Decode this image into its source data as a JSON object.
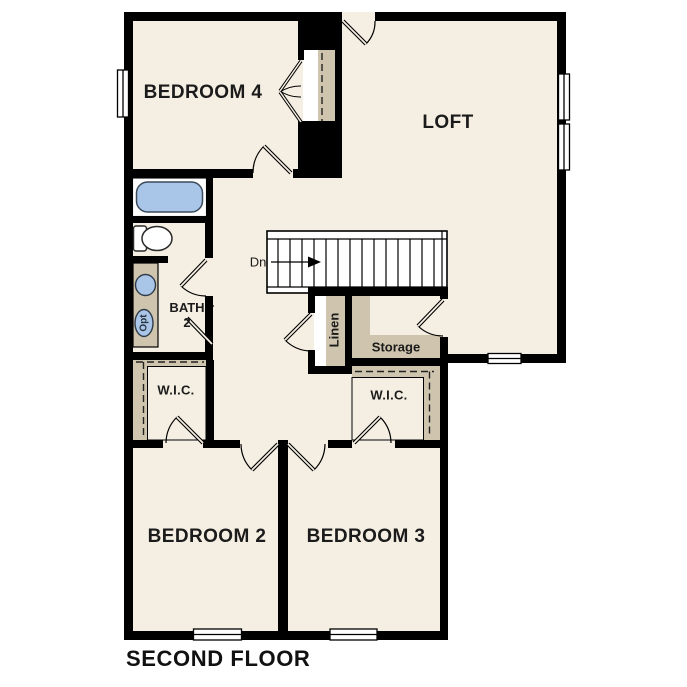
{
  "title": "SECOND FLOOR",
  "rooms": {
    "bedroom4": "BEDROOM 4",
    "loft": "LOFT",
    "bath_line1": "BATH",
    "bath_line2": "2",
    "wic_left": "W.I.C.",
    "wic_right": "W.I.C.",
    "linen": "Linen",
    "storage": "Storage",
    "bedroom2": "BEDROOM 2",
    "bedroom3": "BEDROOM 3"
  },
  "annotations": {
    "stairs_direction": "Dn",
    "optional_fixture": "Opt"
  },
  "colors": {
    "floor": "#f5efe3",
    "closet": "#cfc4ae",
    "fixture_blue": "#a9c6e8",
    "wall": "#000000",
    "background": "#ffffff",
    "label": "#1b1b1b"
  }
}
